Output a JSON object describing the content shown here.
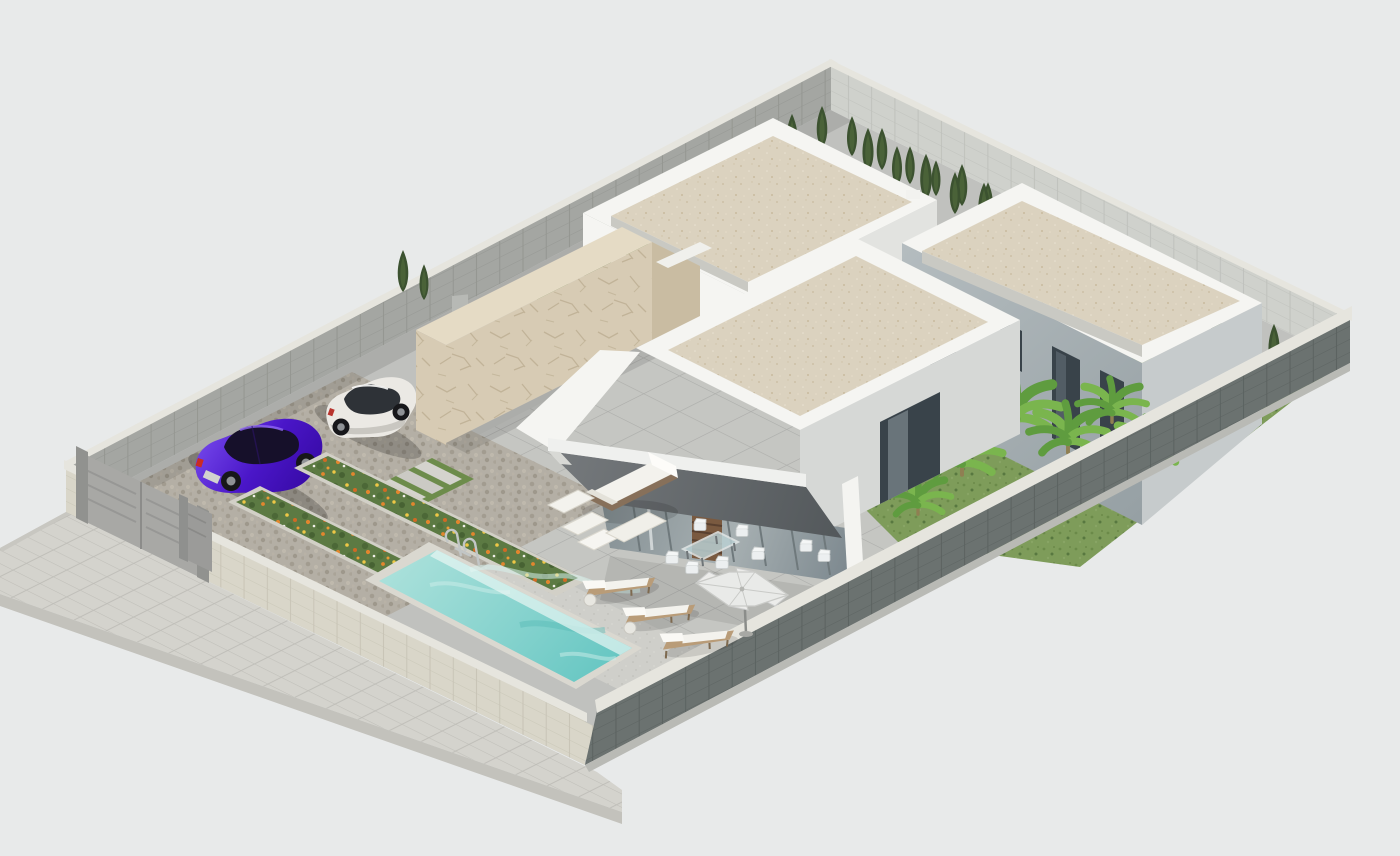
{
  "meta": {
    "title": "Isometric 3D architectural rendering of a modern single-storey villa plot with swimming pool, parking court and garden",
    "canvas": {
      "width": 1400,
      "height": 856
    }
  },
  "palette": {
    "background": "#e8eaea",
    "sidewalk": "#d4d3cd",
    "curb": "#c3c2bc",
    "ground_base": "#c0c1be",
    "wall_white_lit": "#f5f5f2",
    "wall_white_shade": "#e2e3e0",
    "wall_cap": "#e6e5de",
    "roof_sand": "#dbd2bf",
    "stone_clad": "#d7cbb4",
    "stone_clad_shade": "#c9bca2",
    "brick_light": "#d9d6c9",
    "brick_dark": "#6b7270",
    "brick_gray": "#a4a6a2",
    "brick_back": "#cfd1cc",
    "canopy_dark": "#63686b",
    "glass": "#96a0a4",
    "wood_slats": "#7a5a40",
    "gate_gray": "#a8a8a5",
    "window_dark": "#39434a",
    "pool_shallow": "#a9e0da",
    "pool_deep": "#63c5c1",
    "pool_deck": "#cfcfca",
    "paver": "#c5c6c2",
    "cobble": "#b4afa5",
    "grass": "#7e9c5a",
    "grass_dark": "#5c7b44",
    "cypress": "#3c5230",
    "cypress_light": "#55703f",
    "banana_leaf": "#5f9c3f",
    "banana_leaf_light": "#7ab54e",
    "flower_orange": "#e2862e",
    "flower_yellow": "#eec746",
    "car_purple": "#4a16c8",
    "car_purple_light": "#7a4ef0",
    "car_white": "#ebe9e4",
    "metal": "#b9bdbd",
    "cushion_white": "#f3f2ed",
    "wicker": "#87705a"
  },
  "scene": {
    "site": {
      "plot_shape": "isometric rectangle",
      "perimeter_walls": [
        "front-left light brick wall with gates",
        "front-right dark gray brick wall",
        "back-left gray brick wall",
        "back-right light brick wall"
      ],
      "sidewalk": "paved sidewalk along front-left wall",
      "gates": {
        "vehicle_gate_panels": 2,
        "pedestrian_gate_panels": 1,
        "color": "#a8a8a5"
      }
    },
    "buildings": [
      {
        "name": "rear-villa",
        "walls": "#f5f5f2",
        "roof": "flat sand gravel with white parapet",
        "door": "#3f4446"
      },
      {
        "name": "right-villa",
        "walls": "#a6aeb2",
        "roof": "flat sand gravel with white parapet",
        "windows": 4
      },
      {
        "name": "front-villa",
        "walls": "#f5f5f2",
        "roof": "flat sand gravel with white parapet",
        "canopy": "dark gray sloping porch canopy",
        "glazing": "full-height sliding glass",
        "feature": "beige crackle stone courtyard wall"
      }
    ],
    "pool": {
      "water_shallow": "#a9e0da",
      "water_deep": "#63c5c1",
      "ladder": "chrome",
      "shape": "rectangular"
    },
    "vehicles": [
      {
        "name": "purple-sedan",
        "color": "#4a16c8"
      },
      {
        "name": "white-suv",
        "color": "#ebe9e4"
      }
    ],
    "furniture": [
      "wicker sofa with white cushions",
      "two white ottomans",
      "white coffee table",
      "three sun loungers with side tables",
      "glass dining table with chairs",
      "white parasol"
    ],
    "vegetation": {
      "cypress_hedge_back": 16,
      "cypress_trees_top": 12,
      "shrub_row_front": 13,
      "banana_plants": 6,
      "flower_beds": 2,
      "flower_colors": [
        "#e2862e",
        "#eec746",
        "#cf6a24"
      ]
    }
  }
}
